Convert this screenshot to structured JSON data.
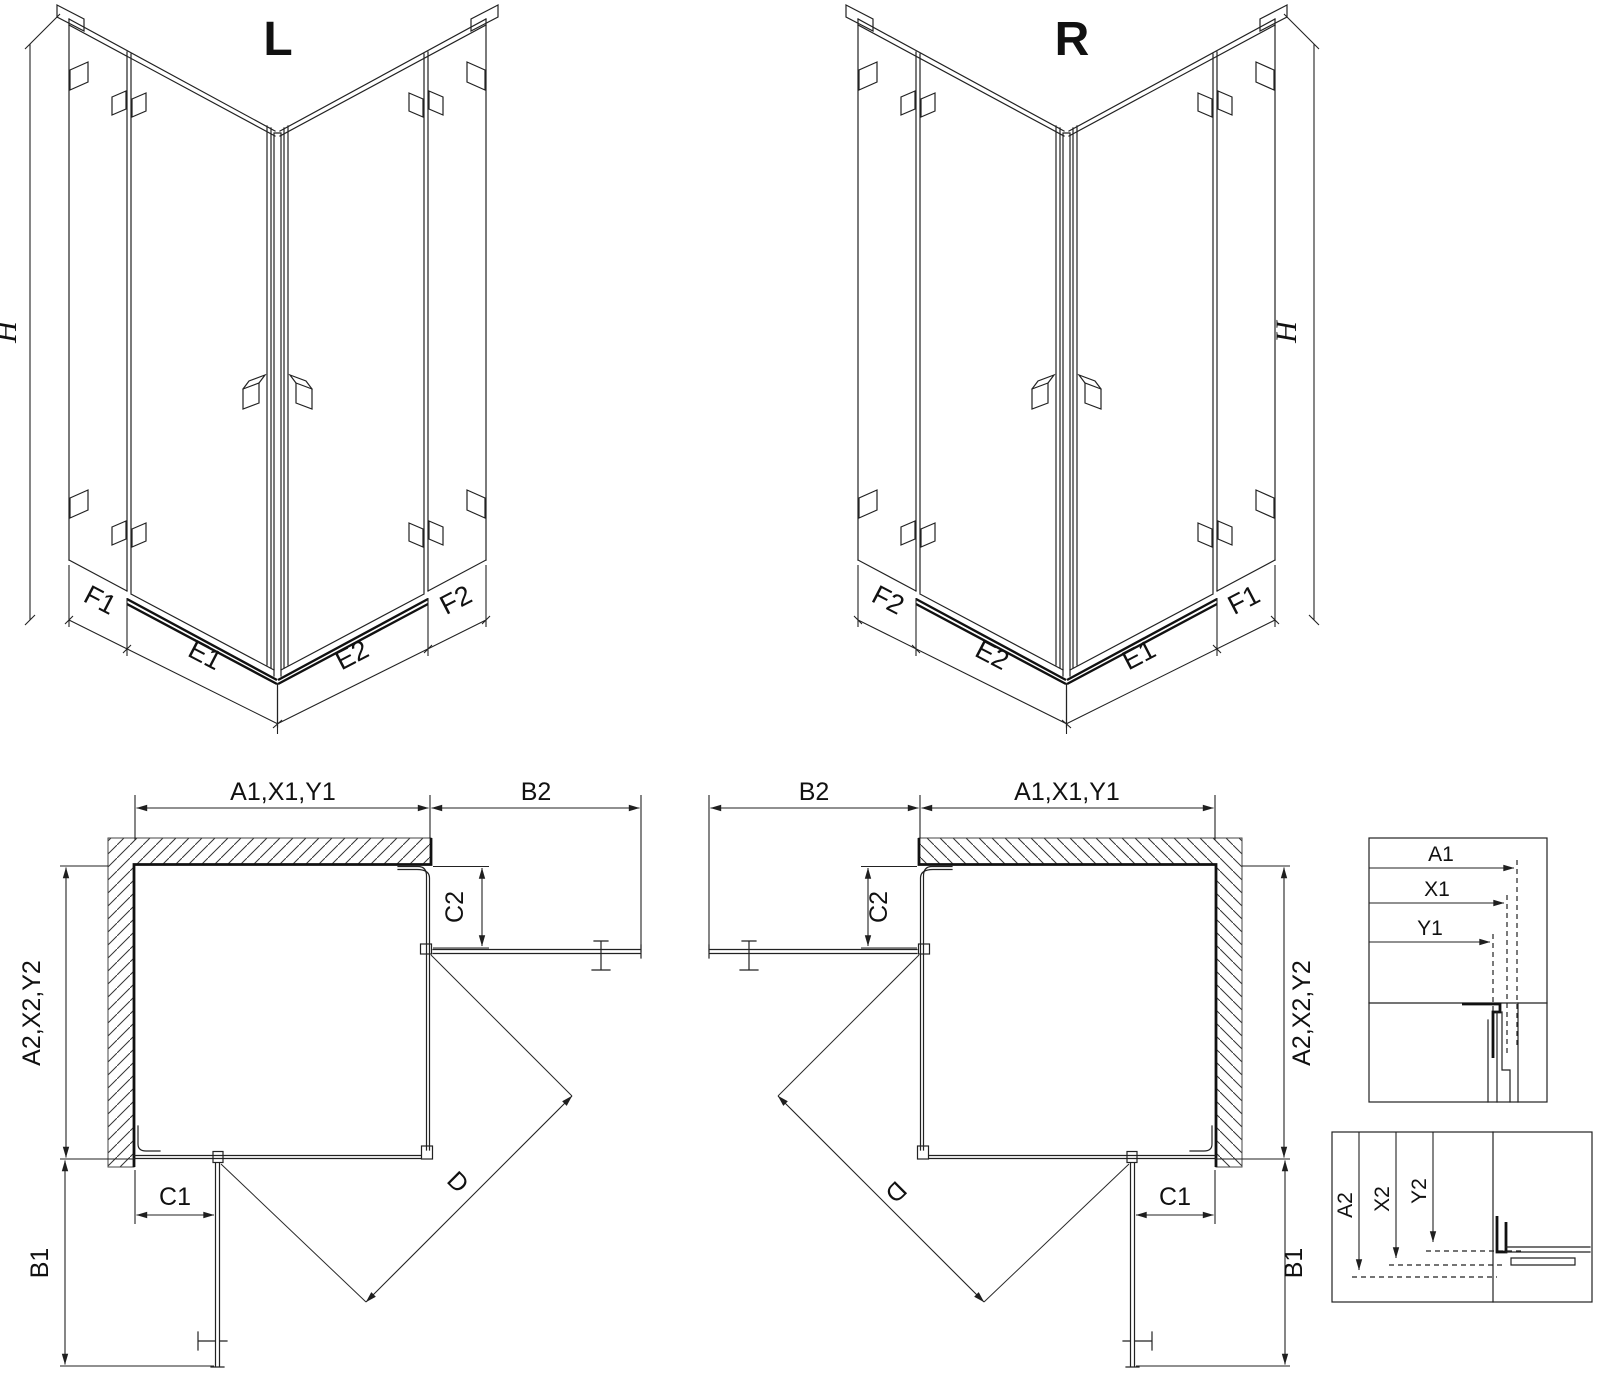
{
  "drawing": {
    "iso_left": {
      "title": "L",
      "h": "H",
      "f1": "F1",
      "e1": "E1",
      "e2": "E2",
      "f2": "F2"
    },
    "iso_right": {
      "title": "R",
      "h": "H",
      "f2": "F2",
      "e2": "E2",
      "e1": "E1",
      "f1": "F1"
    },
    "plan_left": {
      "dim_top": "A1,X1,Y1",
      "dim_top_right": "B2",
      "dim_c2": "C2",
      "dim_left": "A2,X2,Y2",
      "dim_c1": "C1",
      "dim_b1": "B1",
      "dim_d": "D"
    },
    "plan_right": {
      "dim_top_left": "B2",
      "dim_top": "A1,X1,Y1",
      "dim_c2": "C2",
      "dim_right": "A2,X2,Y2",
      "dim_c1": "C1",
      "dim_b1": "B1",
      "dim_d": "D"
    },
    "detail_horizontal": {
      "a1": "A1",
      "x1": "X1",
      "y1": "Y1"
    },
    "detail_vertical": {
      "a2": "A2",
      "x2": "X2",
      "y2": "Y2"
    }
  },
  "colors": {
    "line": "#222222",
    "background": "#ffffff"
  }
}
